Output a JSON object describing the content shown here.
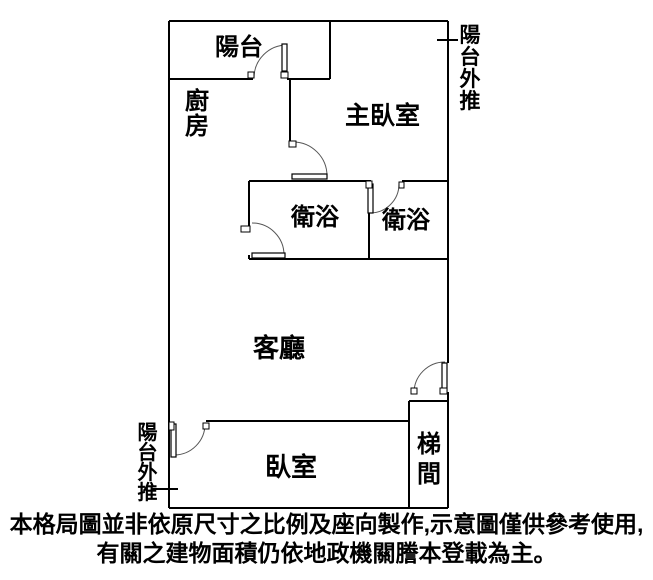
{
  "colors": {
    "background": "#ffffff",
    "line": "#000000",
    "text": "#000000"
  },
  "rooms": {
    "balcony": "陽台",
    "kitchen": "廚房",
    "master_bedroom": "主臥室",
    "bathroom_left": "衛浴",
    "bathroom_right": "衛浴",
    "living_room": "客廳",
    "bedroom": "臥室",
    "stairwell": "梯間"
  },
  "annotations": {
    "balcony_extension_top_right": "陽台外推",
    "balcony_extension_bottom_left": "陽台外推"
  },
  "disclaimer": {
    "line1": "本格局圖並非依原尺寸之比例及座向製作,示意圖僅供參考使用,",
    "line2": "有關之建物面積仍依地政機關謄本登載為主。"
  }
}
